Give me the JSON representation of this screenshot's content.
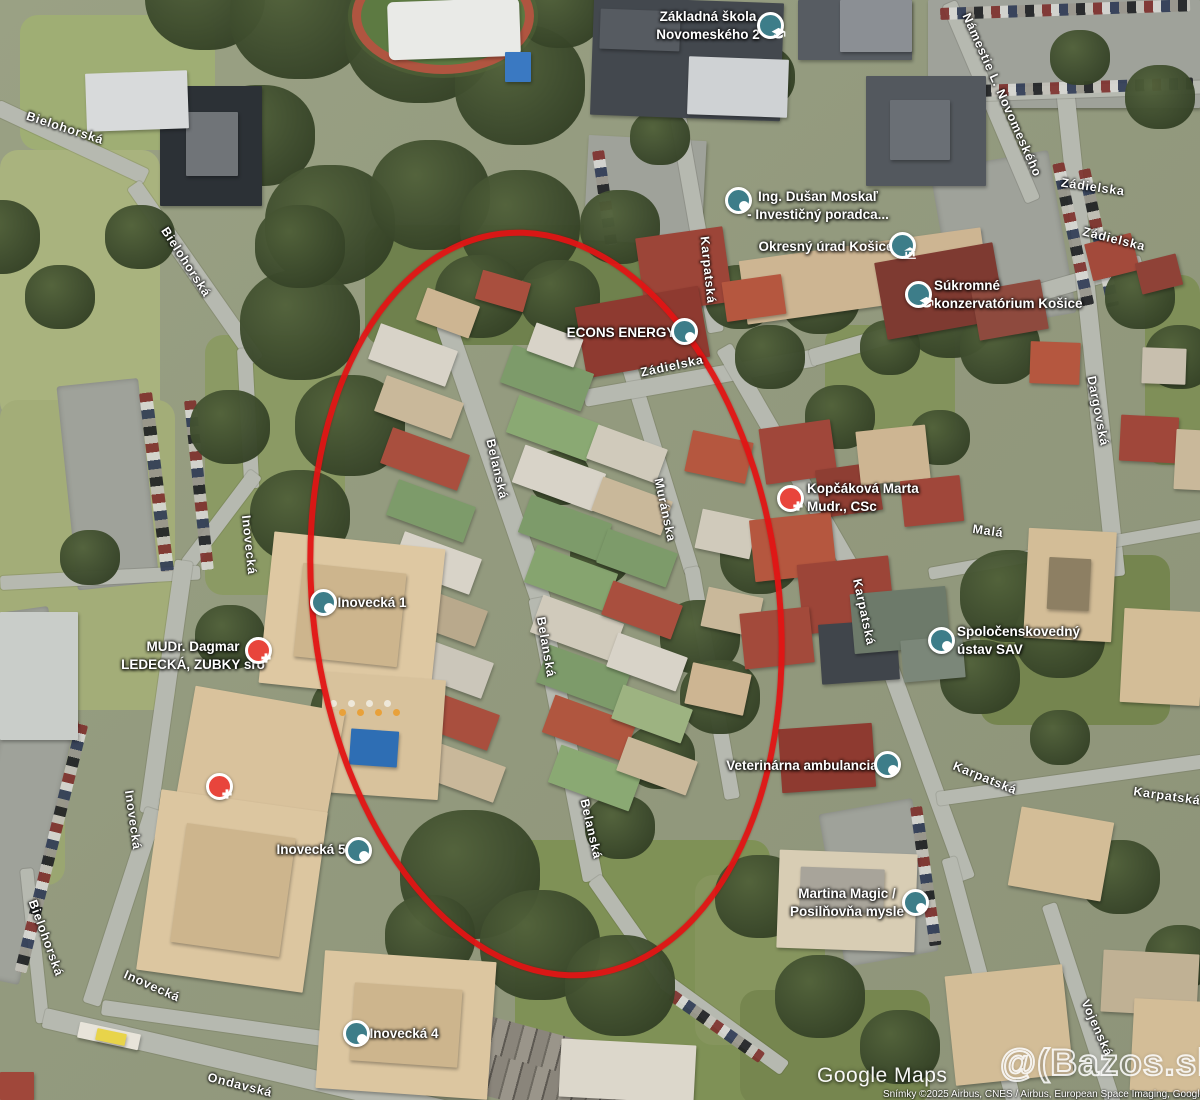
{
  "map": {
    "provider_label": "Google Maps",
    "attribution": "Snímky ©2025 Airbus, CNES / Airbus, European Space Imaging, Google Slovakia, Mapy Ta",
    "watermark": "@(Bazos.sk",
    "annotation": {
      "shape": "ellipse",
      "color": "#e11414",
      "meaning": "highlighted-area"
    },
    "marker_colors": {
      "generic": "#3d7d89",
      "medical": "#e8453c"
    }
  },
  "street_labels": [
    {
      "text": "Bielohorská",
      "x": 65,
      "y": 128,
      "rot": 18
    },
    {
      "text": "Bielohorská",
      "x": 186,
      "y": 262,
      "rot": 57
    },
    {
      "text": "Bielohorská",
      "x": 46,
      "y": 938,
      "rot": 70
    },
    {
      "text": "Inovecká",
      "x": 249,
      "y": 545,
      "rot": 84
    },
    {
      "text": "Inovecká",
      "x": 133,
      "y": 820,
      "rot": 82
    },
    {
      "text": "Inovecká",
      "x": 152,
      "y": 986,
      "rot": 24
    },
    {
      "text": "Ondavská",
      "x": 240,
      "y": 1085,
      "rot": 14
    },
    {
      "text": "Belanská",
      "x": 497,
      "y": 469,
      "rot": 77
    },
    {
      "text": "Belanská",
      "x": 546,
      "y": 647,
      "rot": 80
    },
    {
      "text": "Belanská",
      "x": 591,
      "y": 829,
      "rot": 77
    },
    {
      "text": "Muránska",
      "x": 665,
      "y": 510,
      "rot": 78
    },
    {
      "text": "Karpatská",
      "x": 708,
      "y": 270,
      "rot": 84
    },
    {
      "text": "Karpatská",
      "x": 864,
      "y": 612,
      "rot": 78
    },
    {
      "text": "Karpatská",
      "x": 985,
      "y": 778,
      "rot": 22
    },
    {
      "text": "Karpatská",
      "x": 1167,
      "y": 796,
      "rot": 8
    },
    {
      "text": "Zádielska",
      "x": 672,
      "y": 366,
      "rot": -12
    },
    {
      "text": "Zádielska",
      "x": 1093,
      "y": 187,
      "rot": 8
    },
    {
      "text": "Zádielska",
      "x": 1114,
      "y": 239,
      "rot": 14
    },
    {
      "text": "Námestie L. Novomeského",
      "x": 1002,
      "y": 95,
      "rot": 66
    },
    {
      "text": "Dargovská",
      "x": 1098,
      "y": 411,
      "rot": 79
    },
    {
      "text": "Malá",
      "x": 988,
      "y": 531,
      "rot": 8
    },
    {
      "text": "Vojenská",
      "x": 1097,
      "y": 1028,
      "rot": 66
    }
  ],
  "poi_labels": [
    {
      "id": "zakladna-skola",
      "lines": [
        "Základná škola",
        "Novomeského 2"
      ],
      "tx": 708,
      "ty": 26,
      "mx": 770,
      "my": 25,
      "icon": "school"
    },
    {
      "id": "dusan-moskal",
      "lines": [
        "Ing. Dušan Moskaľ",
        "- Investičný poradca..."
      ],
      "tx": 818,
      "ty": 206,
      "mx": 738,
      "my": 200,
      "icon": "dot"
    },
    {
      "id": "okresny-urad",
      "lines": [
        "Okresný úrad Košice"
      ],
      "tx": 826,
      "ty": 247,
      "mx": 902,
      "my": 245,
      "icon": "civic"
    },
    {
      "id": "konzervatorium",
      "lines": [
        "Súkromné",
        "konzervatórium Košice"
      ],
      "tx": 1002,
      "ty": 295,
      "mx": 918,
      "my": 294,
      "icon": "school",
      "align": "left",
      "lx": 934
    },
    {
      "id": "econs-energy",
      "lines": [
        "ECONS ENERGY"
      ],
      "tx": 621,
      "ty": 333,
      "mx": 684,
      "my": 331,
      "icon": "dot"
    },
    {
      "id": "kopcakova",
      "lines": [
        "Kopčáková Marta",
        "Mudr., CSc"
      ],
      "tx": 858,
      "ty": 498,
      "mx": 790,
      "my": 498,
      "icon": "medical",
      "align": "left",
      "lx": 807
    },
    {
      "id": "inovecka-1",
      "lines": [
        "Inovecká 1"
      ],
      "tx": 372,
      "ty": 603,
      "mx": 323,
      "my": 602,
      "icon": "dot"
    },
    {
      "id": "mudr-ledecka",
      "lines": [
        "MUDr. Dagmar",
        "LEDECKÁ, ZUBKY sro"
      ],
      "tx": 193,
      "ty": 656,
      "mx": 258,
      "my": 650,
      "icon": "medical"
    },
    {
      "id": "ustav-sav",
      "lines": [
        "Spoločenskovedný",
        "ústav SAV"
      ],
      "tx": 1012,
      "ty": 641,
      "mx": 941,
      "my": 640,
      "icon": "dot",
      "align": "left",
      "lx": 957
    },
    {
      "id": "veterinarna",
      "lines": [
        "Veterinárna ambulancia"
      ],
      "tx": 802,
      "ty": 766,
      "mx": 887,
      "my": 764,
      "icon": "dot"
    },
    {
      "id": "martina-magic",
      "lines": [
        "Martina Magic /",
        "Posilňovňa mysle"
      ],
      "tx": 847,
      "ty": 903,
      "mx": 915,
      "my": 902,
      "icon": "dot"
    },
    {
      "id": "inovecka-5",
      "lines": [
        "Inovecká 5"
      ],
      "tx": 311,
      "ty": 850,
      "mx": 358,
      "my": 850,
      "icon": "dot"
    },
    {
      "id": "inovecka-4",
      "lines": [
        "Inovecká 4"
      ],
      "tx": 404,
      "ty": 1034,
      "mx": 356,
      "my": 1033,
      "icon": "dot"
    },
    {
      "id": "medical-marker",
      "lines": [],
      "mx": 219,
      "my": 786,
      "icon": "medical"
    }
  ]
}
